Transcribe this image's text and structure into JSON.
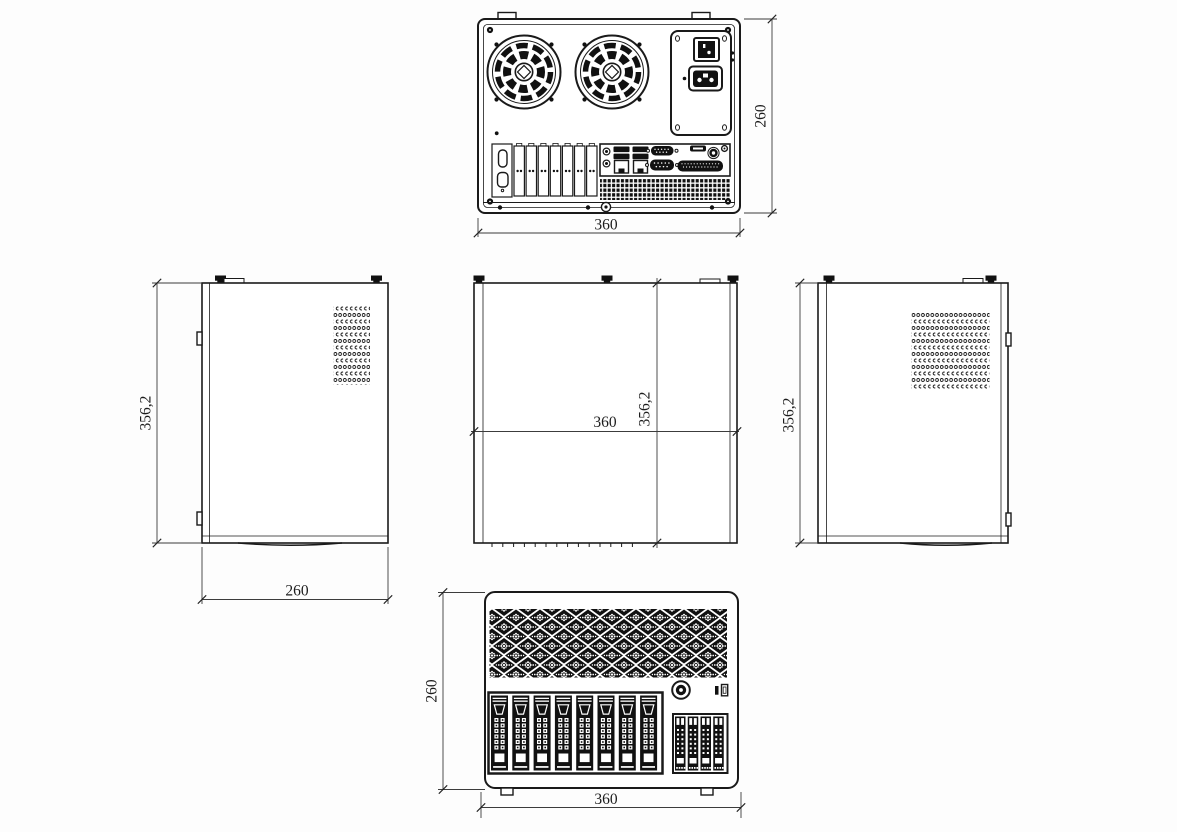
{
  "canvas": {
    "background": "#fdfdfd",
    "line_color": "#1a1a1a"
  },
  "views": {
    "rear": {
      "dim_width": "360",
      "dim_height": "260"
    },
    "left_side": {
      "dim_height": "356,2",
      "dim_depth": "260"
    },
    "top": {
      "dim_width": "360",
      "dim_depth": "356,2"
    },
    "right_side": {
      "dim_height": "356,2"
    },
    "front": {
      "dim_width": "360",
      "dim_height": "260"
    }
  }
}
